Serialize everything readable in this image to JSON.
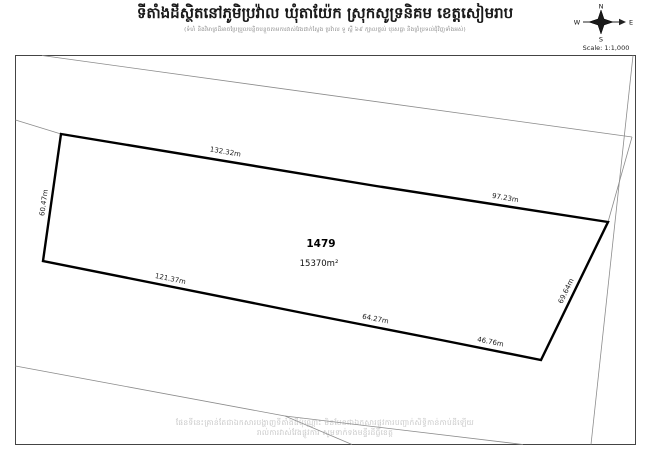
{
  "page": {
    "title": "ទីតាំងដីស្ថិតនៅភូមិប្រវ៉ាល ឃុំតាយ៉ែក ស្រុកសូទ្រនិគម ខេត្តសៀមរាប",
    "subtitle": "(ទំហំ និងវិមាត្រដីអាចប្រែប្រួលបន្តិចបន្តួចតាមការវាស់វែងជាក់ស្តែង ប្រវ៉ាល ទួ ស្ពឺ ៦៩ ក្បាលថ្នល់ បុរសធ្លា និងព្រំប្រទល់ជុំវិញទាំងអស់)"
  },
  "compass": {
    "north": "N",
    "south": "S",
    "east": "E",
    "west": "W",
    "scale_label": "Scale: 1:1,000"
  },
  "parcel": {
    "number": "1479",
    "area": "15370m²"
  },
  "measurements": {
    "top_left": "132.32m",
    "top_right": "97.23m",
    "left": "60.47m",
    "bottom_left": "121.37m",
    "bottom_mid": "64.27m",
    "bottom_right": "46.76m",
    "right": "69.64m"
  },
  "watermark": {
    "line1": "ផែនទីនេះគ្រាន់តែជាឯកសារបង្ហាញទីតាំងដីប៉ុណ្ណោះ មិនមែនជាឯកសារផ្លូវការបញ្ជាក់សិទ្ធិកាន់កាប់ដីឡើយ",
    "line2": "រាល់ការវាស់វែងផ្លូវការ សូមទាក់ទងមន្ទីរដីធ្លីខេត្ត"
  },
  "colors": {
    "parcel_line": "#000000",
    "neighbor_line": "#8c8c8c",
    "frame": "#444444",
    "label": "#222222"
  }
}
